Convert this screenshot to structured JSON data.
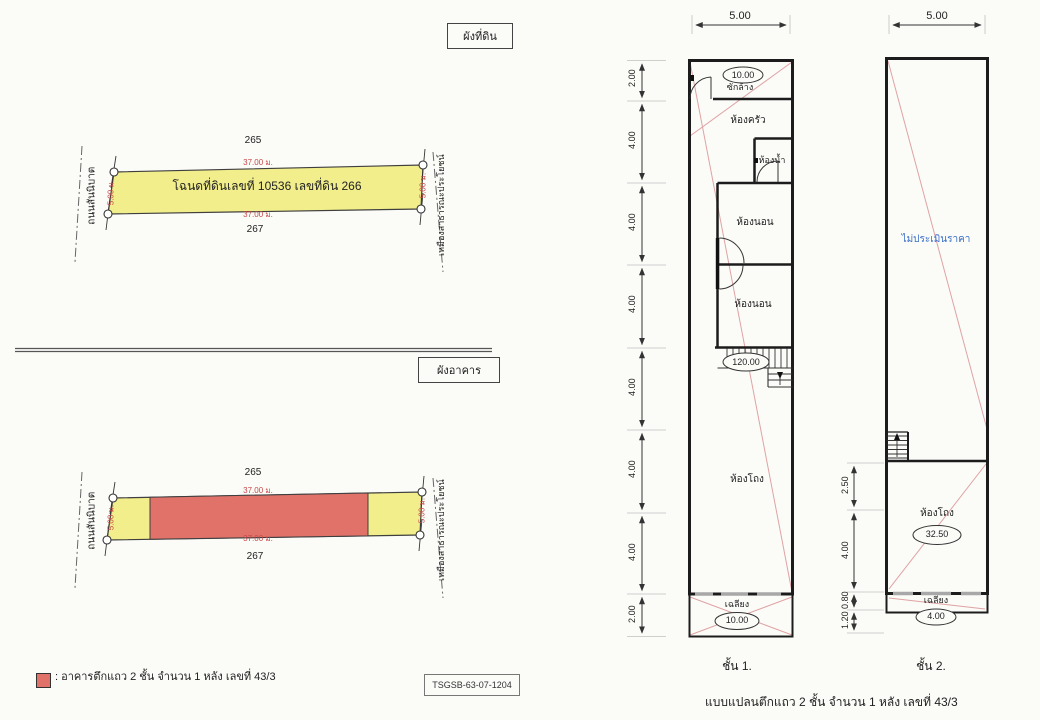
{
  "page": {
    "background": "#fbfbf8"
  },
  "colors": {
    "parcel_yellow": "#f1ee8b",
    "building_red": "#e0726a",
    "diagonal_pink": "#dfa3a3",
    "dimension_red": "#c84848",
    "note_blue": "#3a6fc8",
    "wall_black": "#1c1c1c"
  },
  "land_plan": {
    "title": "ผังที่ดิน",
    "parcel_north": "265",
    "parcel_south": "267",
    "deed_label": "โฉนดที่ดินเลขที่ 10536 เลขที่ดิน 266",
    "width_top": "37.00 ม.",
    "width_bottom": "37.00 ม.",
    "side_left": "5.00 ม.",
    "side_right": "5.00 ม.",
    "road_left": "ถนนสันนิบาต",
    "canal_right": "เหมืองสาธารณะประโยชน์"
  },
  "building_plan": {
    "title": "ผังอาคาร",
    "parcel_north": "265",
    "parcel_south": "267",
    "width_top": "37.00 ม.",
    "width_bottom": "37.00 ม.",
    "side_left": "5.00 ม.",
    "side_right": "5.00 ม.",
    "road_left": "ถนนสันนิบาต",
    "canal_right": "เหมืองสาธารณะประโยชน์"
  },
  "legend": {
    "text": ": อาคารตึกแถว 2 ชั้น จำนวน 1 หลัง เลขที่ 43/3"
  },
  "ref_code": "TSGSB-63-07-1204",
  "floor1": {
    "caption": "ชั้น 1.",
    "top_dim": "5.00",
    "left_dims": [
      "2.00",
      "4.00",
      "4.00",
      "4.00",
      "4.00",
      "4.00",
      "4.00",
      "2.00"
    ],
    "rooms": {
      "wash": "ซักล้าง",
      "kitchen": "ห้องครัว",
      "bath": "ห้องน้ำ",
      "bed1": "ห้องนอน",
      "bed2": "ห้องนอน",
      "hall": "ห้องโถง",
      "porch": "เฉลียง"
    },
    "areas": {
      "wash": "10.00",
      "main": "120.00",
      "porch": "10.00"
    }
  },
  "floor2": {
    "caption": "ชั้น 2.",
    "top_dim": "5.00",
    "left_dims": [
      "2.50",
      "4.00",
      "0.80",
      "1.20"
    ],
    "note": "ไม่ประเมินราคา",
    "rooms": {
      "hall": "ห้องโถง",
      "porch": "เฉลียง"
    },
    "areas": {
      "hall": "32.50",
      "porch": "4.00"
    }
  },
  "footer": "แบบแปลนตึกแถว 2 ชั้น จำนวน 1 หลัง เลขที่ 43/3"
}
